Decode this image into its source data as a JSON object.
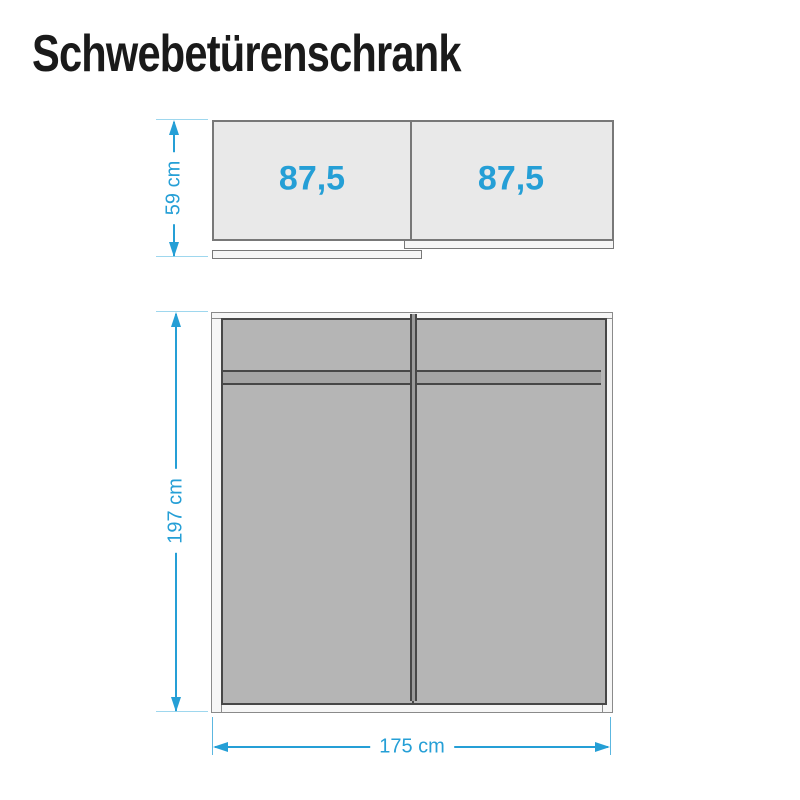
{
  "title": "Schwebetürenschrank",
  "colors": {
    "accent": "#259fd6",
    "tickline": "#9ed7ee",
    "titlecolor": "#1a1a1a",
    "panelfill": "#e9e9e9",
    "panelborder": "#787878",
    "framefill": "#f6f6f6",
    "frameborder": "#8a8a8a",
    "doorfill": "#b5b5b5",
    "doorborder": "#474747",
    "bandfill": "#a4a4a4",
    "dividerfill": "#9a9a9a"
  },
  "top_view": {
    "description": "plan view of sliding-door wardrobe",
    "depth_label": "59 cm",
    "compartments": [
      {
        "width_label": "87,5"
      },
      {
        "width_label": "87,5"
      }
    ]
  },
  "front_view": {
    "description": "front view of sliding-door wardrobe",
    "height_label": "197 cm",
    "width_label": "175 cm"
  }
}
